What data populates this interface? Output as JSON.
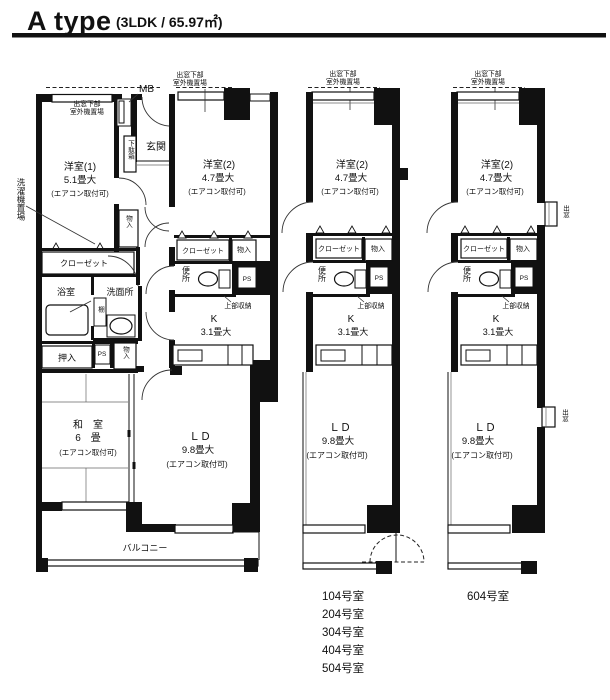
{
  "title": {
    "name": "A type",
    "spec": "(3LDK / 65.97㎡)"
  },
  "shared": {
    "demado_shita_line1": "出窓下部",
    "demado_shita_line2": "室外機置場",
    "room2_name": "洋室(2)",
    "room2_size": "4.7畳大",
    "aircon_note": "(エアコン取付可)",
    "closet": "クローゼット",
    "storage": "物入",
    "toilet": "便所",
    "ps": "PS",
    "upper_storage": "上部収納",
    "kitchen_name": "K",
    "kitchen_size": "3.1畳大",
    "ld_name": "ＬＤ",
    "ld_size": "9.8畳大",
    "bay_window": "出窓"
  },
  "plan_main": {
    "mb": "MB",
    "entrance": "玄関",
    "shoe_cabinet": "下駄箱",
    "room1_name": "洋室(1)",
    "room1_size": "5.1畳大",
    "laundry_space": "洗濯機置場",
    "bath": "浴室",
    "washroom": "洗面所",
    "shelf": "棚",
    "oshiire": "押入",
    "washitsu_name": "和　室",
    "washitsu_size": "6　畳",
    "balcony": "バルコニー"
  },
  "room_numbers": {
    "middle_plan": [
      "104号室",
      "204号室",
      "304号室",
      "404号室",
      "504号室"
    ],
    "right_plan": "604号室"
  },
  "colors": {
    "ink": "#111111",
    "background": "#ffffff"
  }
}
